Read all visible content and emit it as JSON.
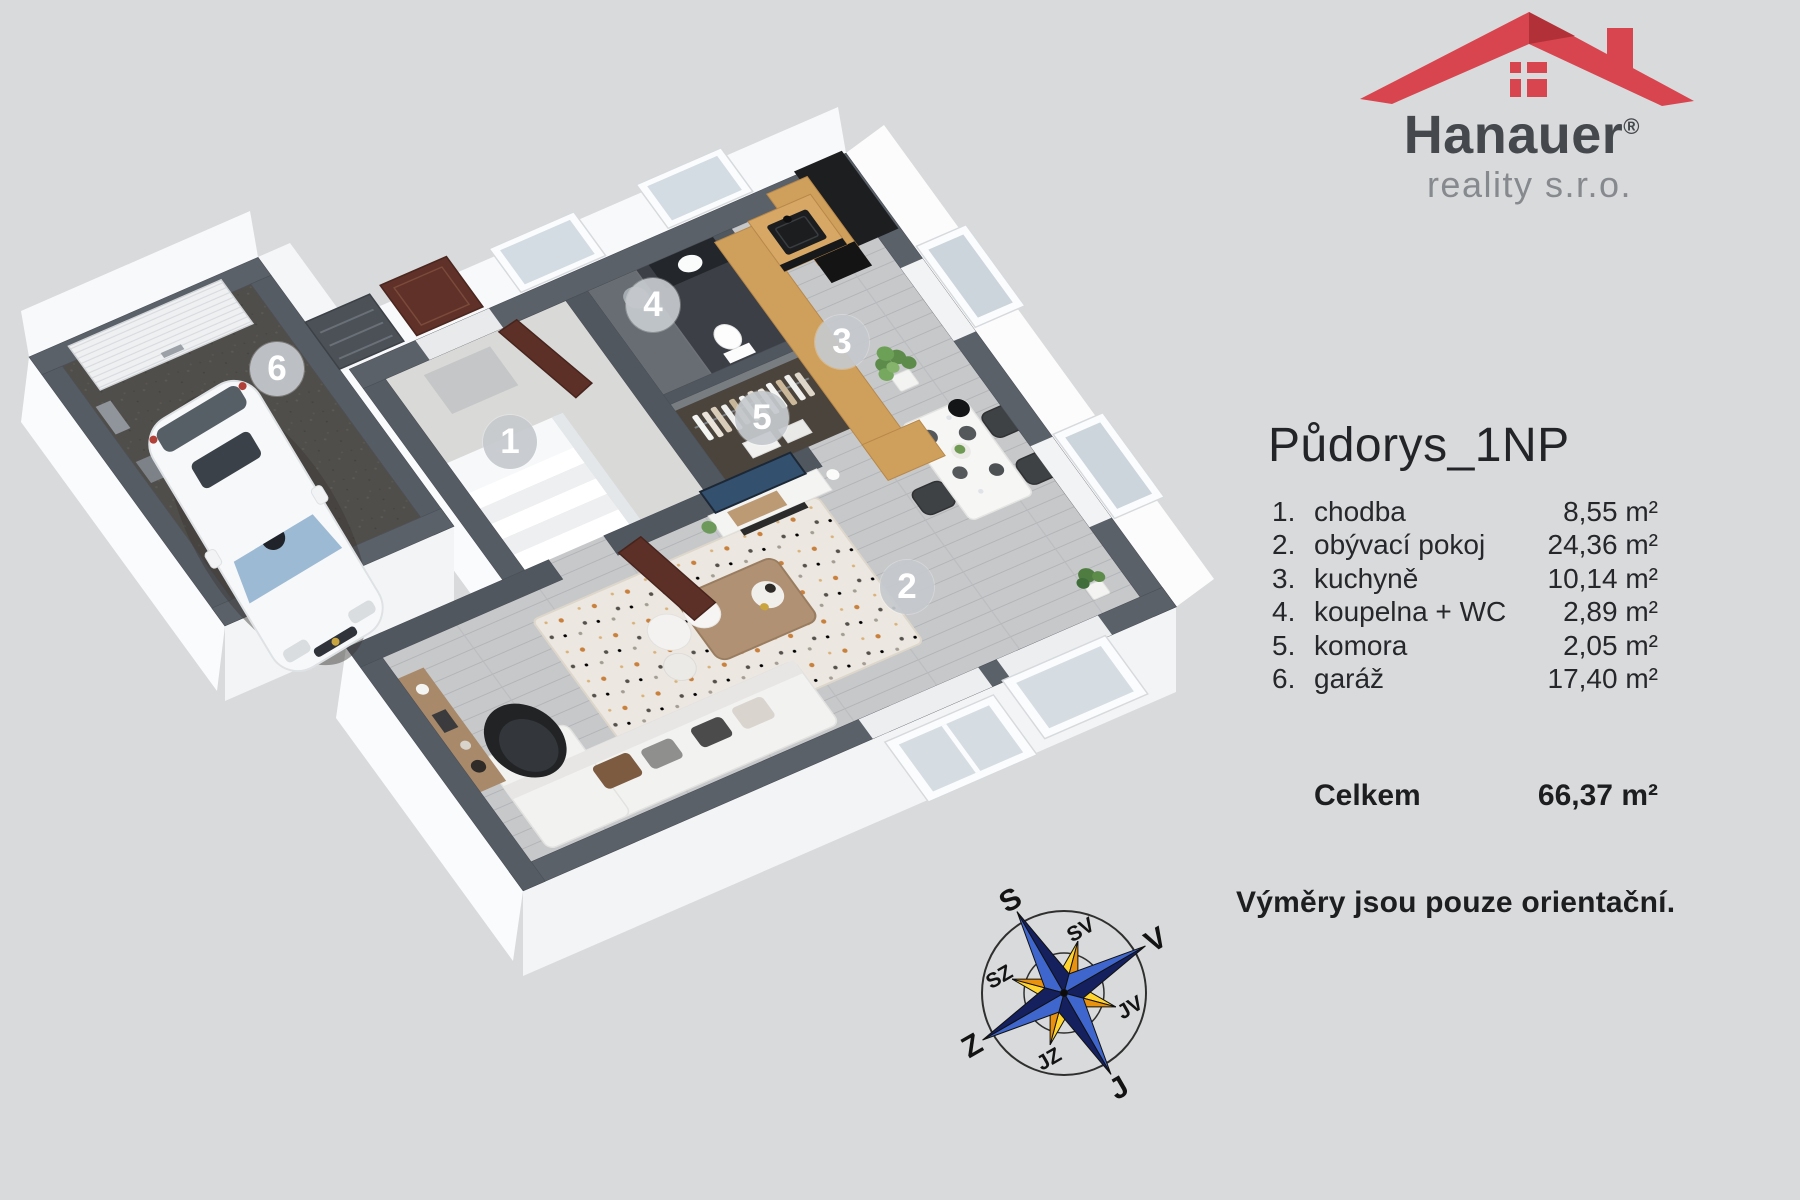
{
  "logo": {
    "brand": "Hanauer",
    "registered": "®",
    "subtitle": "reality s.r.o."
  },
  "panel": {
    "title": "Půdorys_1NP",
    "rooms": [
      {
        "num": "1.",
        "name": "chodba",
        "area": "8,55 m²"
      },
      {
        "num": "2.",
        "name": "obývací pokoj",
        "area": "24,36 m²"
      },
      {
        "num": "3.",
        "name": "kuchyně",
        "area": "10,14 m²"
      },
      {
        "num": "4.",
        "name": "koupelna + WC",
        "area": "2,89 m²"
      },
      {
        "num": "5.",
        "name": "komora",
        "area": "2,05 m²"
      },
      {
        "num": "6.",
        "name": "garáž",
        "area": "17,40 m²"
      }
    ],
    "total_label": "Celkem",
    "total_value": "66,37 m²",
    "note": "Výměry jsou pouze orientační."
  },
  "badges": {
    "b1": "1",
    "b2": "2",
    "b3": "3",
    "b4": "4",
    "b5": "5",
    "b6": "6"
  },
  "compass": {
    "labels": [
      "S",
      "SV",
      "V",
      "JV",
      "J",
      "JZ",
      "Z",
      "SZ"
    ]
  },
  "colors": {
    "background": "#d9dadb",
    "roof_red": "#d8454e",
    "wall_top": "#5b6169",
    "needle_blue": "#3f66cc",
    "needle_navy": "#15205f",
    "needle_orange": "#e8920f",
    "needle_yellow": "#ffd42e"
  }
}
